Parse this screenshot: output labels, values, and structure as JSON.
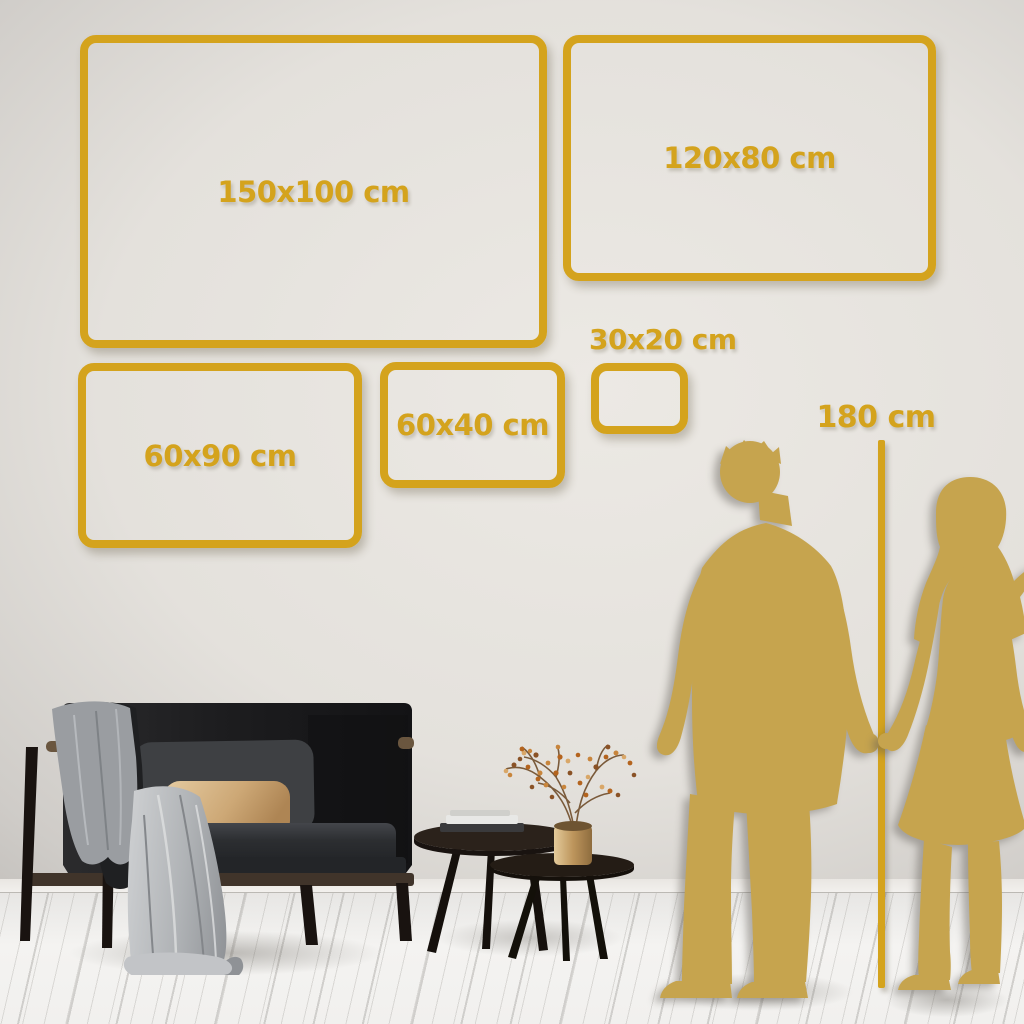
{
  "guide": {
    "size_frames": [
      {
        "id": "150x100",
        "label": "150x100 cm"
      },
      {
        "id": "120x80",
        "label": "120x80 cm"
      },
      {
        "id": "60x90",
        "label": "60x90 cm"
      },
      {
        "id": "60x40",
        "label": "60x40 cm"
      },
      {
        "id": "30x20",
        "label": "30x20 cm"
      }
    ],
    "height_marker": {
      "label": "180 cm"
    }
  },
  "illustrations": {
    "figures": [
      "man-silhouette",
      "woman-silhouette"
    ],
    "room_objects": [
      "sofa",
      "throw-blanket",
      "back-cushion",
      "accent-pillow",
      "nesting-coffee-tables",
      "stacked-books",
      "brass-vase",
      "dried-flower-branch"
    ]
  },
  "palette": {
    "gold": "#D4A31D",
    "silhouette_gold": "#C6A44E",
    "wall": "#E4E1DC",
    "floor": "#F2F1EF",
    "sofa_dark": "#1E1F21",
    "pillow_beige": "#D3B183",
    "blanket_gray": "#A7AAAD",
    "wood_dark": "#241C15",
    "vase_brass": "#C49A5F"
  }
}
